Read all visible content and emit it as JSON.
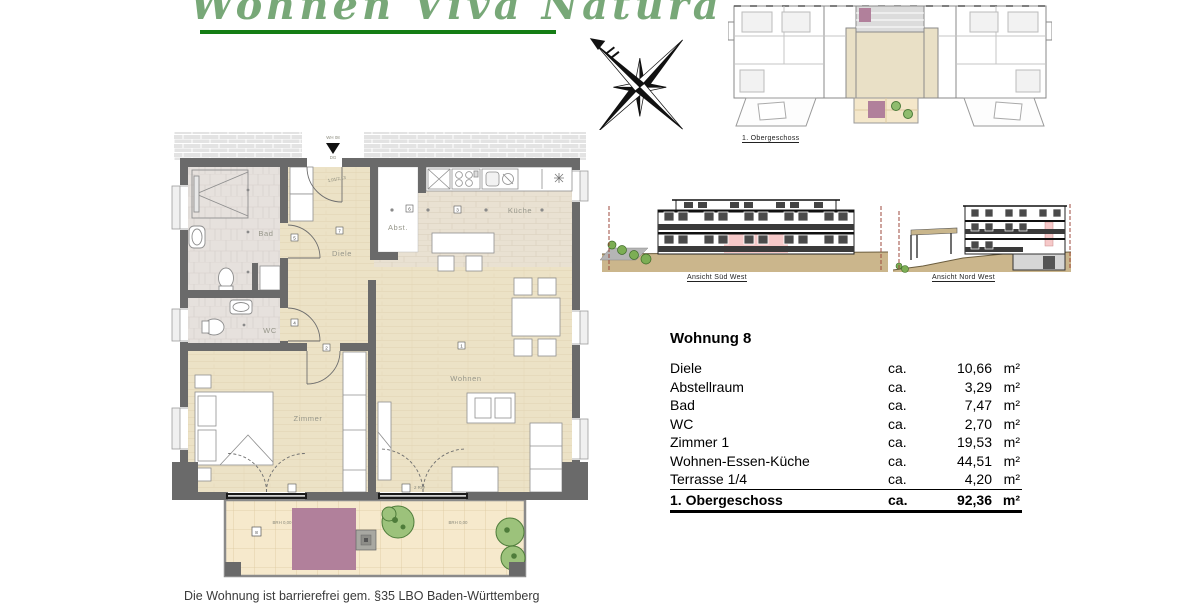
{
  "logo": {
    "text": "Wohnen  Viva Natura",
    "accent_color": "#157d15"
  },
  "overview": {
    "caption": "1. Obergeschoss"
  },
  "elevations": {
    "southwest_caption": "Ansicht Süd West",
    "northwest_caption": "Ansicht Nord West"
  },
  "area_table": {
    "title": "Wohnung 8",
    "ca_label": "ca.",
    "unit": "m²",
    "rows": [
      {
        "label": "Diele",
        "value": "10,66"
      },
      {
        "label": "Abstellraum",
        "value": "3,29"
      },
      {
        "label": "Bad",
        "value": "7,47"
      },
      {
        "label": "WC",
        "value": "2,70"
      },
      {
        "label": "Zimmer 1",
        "value": "19,53"
      },
      {
        "label": "Wohnen-Essen-Küche",
        "value": "44,51"
      },
      {
        "label": "Terrasse  1/4",
        "value": "4,20"
      }
    ],
    "total": {
      "label": "1. Obergeschoss",
      "value": "92,36"
    }
  },
  "floor_plan": {
    "room_labels": {
      "bad": "Bad",
      "wc": "WC",
      "diele": "Diele",
      "abst": "Abst.",
      "kueche": "Küche",
      "zimmer": "Zimmer",
      "wohnen": "Wohnen"
    },
    "markers": {
      "m1": "1",
      "m2": "2",
      "m3": "3",
      "m4": "4",
      "m5": "5",
      "m6": "6",
      "m7": "7",
      "m8": "8"
    },
    "entry": {
      "label_top": "WH 08",
      "label_bottom": "DG",
      "door_dim": "1,01/2,13"
    },
    "terrace": {
      "brh_left": "BRH 0,00",
      "brh_right": "BRH 0,00",
      "rw_label": "2 RW"
    }
  },
  "footer": {
    "disclaimer": "Die Wohnung ist barrierefrei gem. §35 LBO Baden-Württemberg"
  }
}
